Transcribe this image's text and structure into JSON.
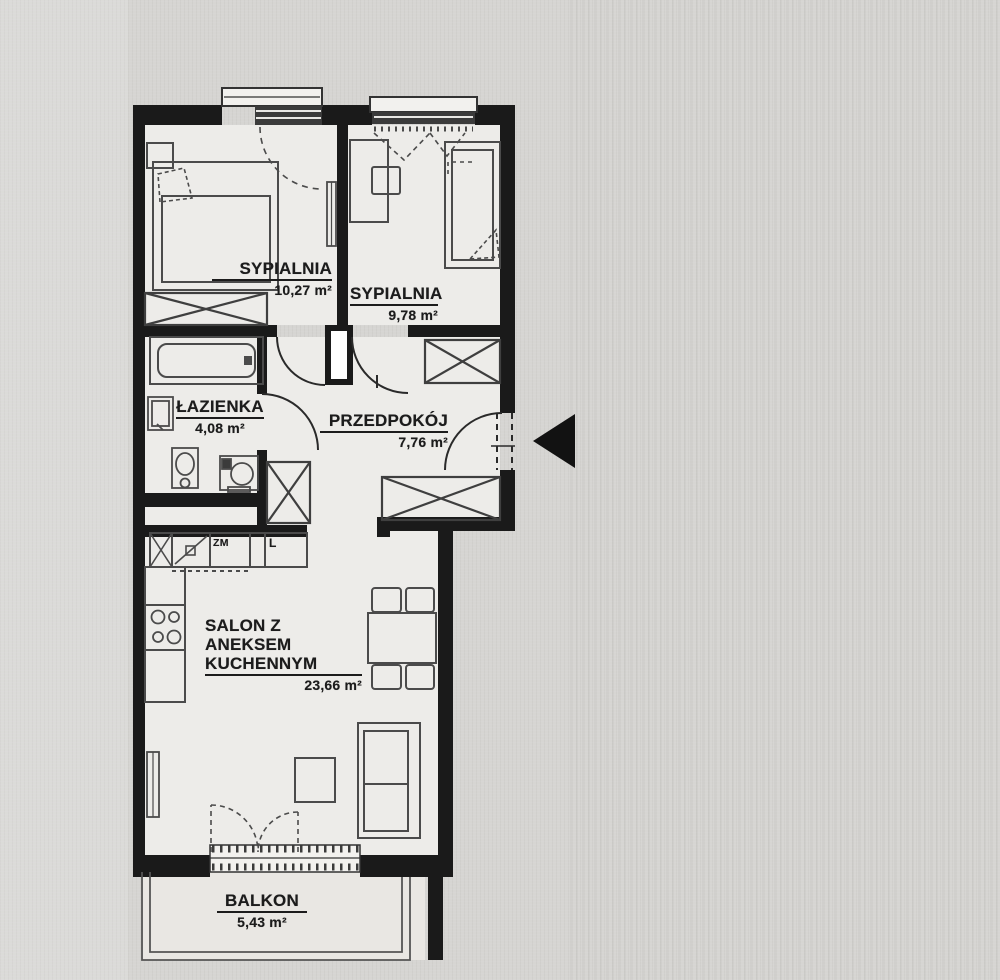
{
  "plan": {
    "rooms": [
      {
        "id": "sypialnia-1",
        "name": "SYPIALNIA",
        "area": "10,27 m²"
      },
      {
        "id": "sypialnia-2",
        "name": "SYPIALNIA",
        "area": "9,78 m²"
      },
      {
        "id": "lazienka",
        "name": "ŁAZIENKA",
        "area": "4,08 m²"
      },
      {
        "id": "przedpokoj",
        "name": "PRZEDPOKÓJ",
        "area": "7,76 m²"
      },
      {
        "id": "salon",
        "name_line1": "SALON Z ANEKSEM",
        "name_line2": "KUCHENNYM",
        "area": "23,66 m²"
      },
      {
        "id": "balkon",
        "name": "BALKON",
        "area": "5,43 m²"
      }
    ],
    "kitchen": {
      "dishwasher_label": "ZM",
      "fridge_label": "L"
    },
    "colors": {
      "wall": "#1a1a1a",
      "furniture": "#4b4b4b",
      "paper": "#d6d5d2",
      "floor": "#edece9"
    }
  }
}
